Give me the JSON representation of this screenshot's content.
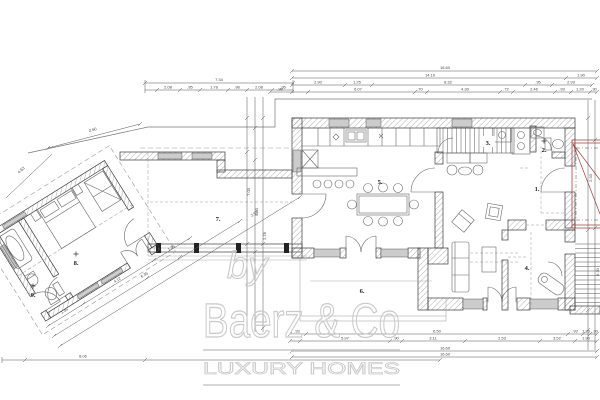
{
  "plan": {
    "type": "architectural-floor-plan",
    "floor": "ground floor"
  },
  "rooms": {
    "r1": "1.",
    "r2": "2.",
    "r3": "3.",
    "r4": "4.",
    "r5": "5.",
    "r6": "6.",
    "r7": "7.",
    "r8": "8.",
    "r9": "9."
  },
  "dimensions": {
    "top": {
      "total": "16.60",
      "row2": [
        "14.10",
        "1.90"
      ],
      "row3": [
        "2.90",
        "1.25",
        "8.32",
        ".95",
        "2.93"
      ],
      "row4": [
        ".98",
        "6.07",
        ".70",
        "4.30",
        ".72",
        "2.46",
        ".93",
        "1.20",
        ".30"
      ]
    },
    "left": {
      "total": "7.34",
      "chain": [
        "2.08",
        ".95",
        "1.78",
        ".98",
        "2.08",
        ".95"
      ]
    },
    "bottom": {
      "row1": [
        ".93",
        "6.50",
        ".93",
        "1.20",
        ".30"
      ],
      "row2": [
        "5.97",
        ".90",
        "3.11",
        "2.53",
        "3.52",
        "1.90"
      ],
      "total1": "16.60",
      "total2": "16.60",
      "site": "8.06"
    },
    "diag": {
      "upper": [
        "2.60",
        "4.63"
      ],
      "wing": [
        "1.35",
        "4.12",
        "1.35",
        "6.35",
        "2.93"
      ]
    },
    "vertical": {
      "corridor": [
        "7.03",
        "9.00",
        "2.78"
      ],
      "right": [
        "2.93",
        "6.30"
      ]
    }
  },
  "watermark": {
    "by": "by",
    "brand": "Baerz & Co",
    "tagline": "LUXURY HOMES"
  },
  "colors": {
    "wall_line": "#3a3a3a",
    "hatch": "#8a8a8a",
    "window_fill": "#cccccc",
    "furniture": "#666666",
    "dim_color": "#444444",
    "accent_red": "#a84038",
    "watermark_gray": "#c9c9c9"
  }
}
